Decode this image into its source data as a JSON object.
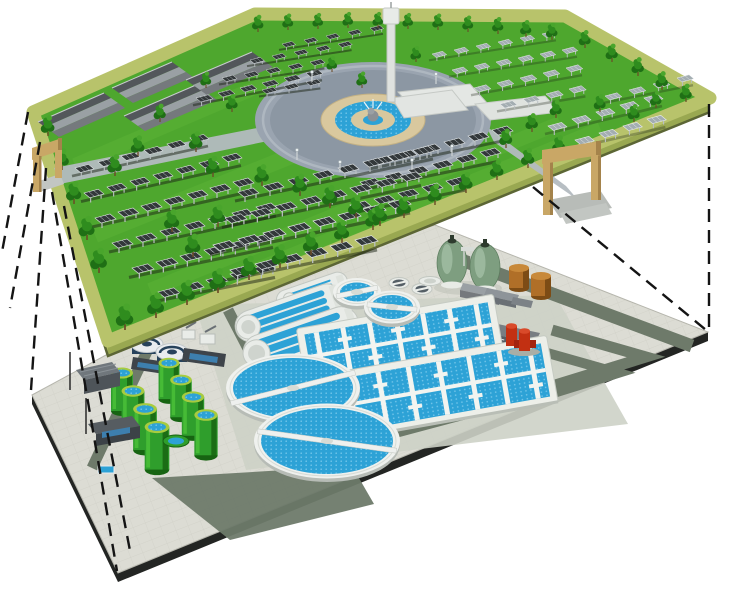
{
  "scene": {
    "type": "exploded-axonometric-illustration",
    "upper_level": {
      "name": "ground-level-solar-park",
      "features": [
        "solar-panel-arrays",
        "landscaped-trees",
        "central-fountain-plaza",
        "service-buildings",
        "observation-tower",
        "entrance-gates",
        "perimeter-edge-band",
        "access-roads"
      ]
    },
    "lower_level": {
      "name": "underground-wastewater-treatment-plant",
      "features": [
        "inlet-pump-station",
        "sludge-thickeners",
        "green-storage-tanks",
        "oxidation-ditches",
        "secondary-clarifiers",
        "aeration-basins",
        "egg-shaped-digesters",
        "gas-holders",
        "blower-buildings",
        "brown-chemical-tanks",
        "red-pipe-gallery",
        "service-roads"
      ]
    },
    "connectors": {
      "type": "dashed-projection-lines",
      "count": 7
    }
  },
  "colors": {
    "background": "#ffffff",
    "park_grass": "#4ea72e",
    "park_grass_light": "#63b93c",
    "park_edge_band": "#b8c36b",
    "park_side_left": "#aeb95f",
    "park_side_right": "#99a851",
    "park_side_shadow": "#5c6635",
    "tree_dark": "#1f6f15",
    "tree_mid": "#2f8c1e",
    "tree_light": "#49a52c",
    "trunk": "#6b4a26",
    "panel_dark": "#33383a",
    "panel_dark_frame": "#e2e6e8",
    "panel_grid": "#c8d0d4",
    "panel_light": "#a3adb1",
    "panel_light_frame": "#eef1f2",
    "panel_leg": "#b9bfc2",
    "row_shadow": "#1c2416",
    "plaza_outer": "#9aa4b0",
    "plaza_inner": "#8c97a3",
    "plaza_ring": "#aeb7c0",
    "fountain_tan": "#d9c89e",
    "fountain_tan_dark": "#c3b184",
    "water_blue": "#2da2d6",
    "water_dot": "#74c6ea",
    "road_upper": "#b3bac0",
    "gate_tan": "#c9a766",
    "gate_tan_dark": "#a4834b",
    "bldg_roof_dark": "#53575b",
    "bldg_roof_light": "#9aa0a4",
    "bldg_wall": "#75797d",
    "tower_white": "#e4e7e4",
    "plant_paving": "#dcdcd4",
    "plant_tile_line": "#c9c9c0",
    "plant_road": "#6e7a6a",
    "plant_apron": "#cdd1c7",
    "slab_edge": "#232523",
    "tank_green": "#2f9e2c",
    "tank_green_light": "#4cc23a",
    "tank_green_dark": "#176412",
    "tank_rim": "#a7cb3f",
    "clarifier_rim": "#eff1ee",
    "clarifier_rim_shadow": "#b7bcb6",
    "machinery_white": "#e9ece8",
    "digester_green": "#7e9e80",
    "digester_green_light": "#a5c0a7",
    "digester_green_dark": "#5c7c5e",
    "digester_cap": "#2e3b2e",
    "brown_tank": "#b06f28",
    "brown_tank_top": "#c8893a",
    "brown_tank_dark": "#7d4c15",
    "red_structure": "#c23012",
    "red_structure_top": "#d94a2a",
    "red_structure_dark": "#a32410",
    "navy_tank": "#27425c",
    "dark_building": "#3e444a",
    "glass_blue": "#3d7fae",
    "projection_line": "#141414"
  },
  "layout": {
    "panel_rows": [
      [
        75,
        168,
        23,
        -6,
        6,
        0.9,
        "d"
      ],
      [
        84,
        193,
        23,
        -6,
        7,
        0.95,
        "d"
      ],
      [
        95,
        218,
        23,
        -6,
        7,
        1,
        "d"
      ],
      [
        112,
        243,
        24,
        -6,
        7,
        1,
        "d"
      ],
      [
        132,
        268,
        24,
        -6,
        6,
        1.05,
        "d"
      ],
      [
        158,
        292,
        24,
        -6,
        5,
        1.05,
        "d"
      ],
      [
        196,
        98,
        22,
        -5,
        6,
        0.8,
        "d"
      ],
      [
        222,
        78,
        22,
        -4,
        5,
        0.72,
        "d"
      ],
      [
        250,
        60,
        22,
        -4,
        5,
        0.68,
        "d"
      ],
      [
        282,
        44,
        22,
        -4,
        5,
        0.65,
        "d"
      ],
      [
        262,
        90,
        22,
        -4,
        3,
        0.72,
        "d"
      ],
      [
        432,
        54,
        22,
        -4,
        6,
        0.7,
        "l"
      ],
      [
        452,
        70,
        22,
        -4,
        6,
        0.75,
        "l"
      ],
      [
        474,
        88,
        23,
        -5,
        5,
        0.8,
        "l"
      ],
      [
        500,
        104,
        23,
        -5,
        4,
        0.82,
        "l"
      ],
      [
        548,
        126,
        24,
        -7,
        5,
        0.9,
        "l"
      ],
      [
        575,
        140,
        24,
        -7,
        4,
        0.92,
        "l"
      ],
      [
        605,
        96,
        24,
        -6,
        4,
        0.8,
        "l"
      ],
      [
        372,
        160,
        24,
        -6,
        6,
        1,
        "d"
      ],
      [
        360,
        182,
        24,
        -6,
        6,
        1,
        "d"
      ],
      [
        350,
        205,
        24,
        -6,
        5,
        1,
        "d"
      ],
      [
        238,
        192,
        25,
        -6,
        8,
        1,
        "d"
      ],
      [
        225,
        218,
        25,
        -6,
        8,
        1.05,
        "d"
      ],
      [
        213,
        245,
        25,
        -6,
        8,
        1.1,
        "d"
      ],
      [
        230,
        270,
        25,
        -6,
        6,
        1.1,
        "d"
      ]
    ],
    "trees": [
      [
        125,
        330,
        1.15
      ],
      [
        156,
        318,
        1.12
      ],
      [
        187,
        305,
        1.1
      ],
      [
        218,
        293,
        1.08
      ],
      [
        249,
        280,
        1.06
      ],
      [
        280,
        268,
        1.04
      ],
      [
        311,
        255,
        1.02
      ],
      [
        342,
        243,
        1.0
      ],
      [
        373,
        230,
        0.98
      ],
      [
        404,
        218,
        0.96
      ],
      [
        435,
        205,
        0.94
      ],
      [
        466,
        193,
        0.92
      ],
      [
        497,
        180,
        0.9
      ],
      [
        528,
        168,
        0.88
      ],
      [
        559,
        155,
        0.86
      ],
      [
        258,
        32,
        0.75
      ],
      [
        288,
        30,
        0.72
      ],
      [
        318,
        29,
        0.7
      ],
      [
        348,
        28,
        0.7
      ],
      [
        378,
        28,
        0.7
      ],
      [
        408,
        29,
        0.7
      ],
      [
        438,
        30,
        0.72
      ],
      [
        468,
        32,
        0.72
      ],
      [
        498,
        34,
        0.74
      ],
      [
        526,
        37,
        0.74
      ],
      [
        552,
        40,
        0.76
      ],
      [
        585,
        48,
        0.78
      ],
      [
        612,
        62,
        0.8
      ],
      [
        638,
        76,
        0.82
      ],
      [
        662,
        90,
        0.82
      ],
      [
        686,
        102,
        0.8
      ],
      [
        48,
        136,
        0.9
      ],
      [
        62,
        170,
        0.95
      ],
      [
        74,
        204,
        1.0
      ],
      [
        87,
        240,
        1.05
      ],
      [
        99,
        273,
        1.1
      ],
      [
        115,
        176,
        0.95
      ],
      [
        138,
        156,
        0.9
      ],
      [
        196,
        152,
        0.9
      ],
      [
        213,
        177,
        0.92
      ],
      [
        172,
        232,
        1.0
      ],
      [
        193,
        257,
        1.02
      ],
      [
        218,
        227,
        0.98
      ],
      [
        262,
        186,
        0.95
      ],
      [
        300,
        196,
        0.97
      ],
      [
        330,
        208,
        1.0
      ],
      [
        356,
        218,
        1.0
      ],
      [
        380,
        226,
        1.0
      ],
      [
        160,
        122,
        0.8
      ],
      [
        206,
        88,
        0.72
      ],
      [
        232,
        112,
        0.78
      ],
      [
        332,
        72,
        0.7
      ],
      [
        362,
        88,
        0.72
      ],
      [
        416,
        62,
        0.7
      ],
      [
        506,
        148,
        0.85
      ],
      [
        532,
        132,
        0.82
      ],
      [
        556,
        118,
        0.8
      ],
      [
        600,
        112,
        0.78
      ],
      [
        634,
        122,
        0.78
      ],
      [
        656,
        108,
        0.76
      ]
    ],
    "green_tanks": [
      [
        122,
        373,
        1.0
      ],
      [
        133,
        391,
        1.04
      ],
      [
        145,
        409,
        1.08
      ],
      [
        157,
        427,
        1.12
      ],
      [
        169,
        363,
        0.95
      ],
      [
        181,
        380,
        0.98
      ],
      [
        193,
        397,
        1.02
      ],
      [
        206,
        415,
        1.06
      ]
    ],
    "clarifiers": [
      {
        "cx": 357,
        "cy": 292,
        "rx": 17,
        "ry": 9.5,
        "rot": -12
      },
      {
        "cx": 392,
        "cy": 307,
        "rx": 21,
        "ry": 12,
        "rot": 6
      },
      {
        "cx": 293,
        "cy": 388,
        "rx": 60,
        "ry": 30,
        "rot": -14
      },
      {
        "cx": 327,
        "cy": 441,
        "rx": 66,
        "ry": 33,
        "rot": 8
      }
    ],
    "basins": [
      {
        "cx": 400,
        "cy": 341,
        "L": 186,
        "W": 46,
        "rot": -10,
        "strips": 7
      },
      {
        "cx": 443,
        "cy": 388,
        "L": 208,
        "W": 54,
        "rot": -10,
        "strips": 7
      }
    ],
    "ditches": [
      {
        "cx": 312,
        "cy": 291,
        "rot": -19,
        "L": 74,
        "W": 20
      },
      {
        "cx": 289,
        "cy": 313,
        "rot": -19,
        "L": 112,
        "W": 32
      },
      {
        "cx": 301,
        "cy": 338,
        "rot": -19,
        "L": 120,
        "W": 35
      }
    ],
    "dashes": [
      [
        28,
        112,
        2,
        252
      ],
      [
        40,
        142,
        10,
        308
      ],
      [
        46,
        168,
        31,
        390
      ],
      [
        52,
        192,
        117,
        571
      ],
      [
        64,
        206,
        131,
        556
      ],
      [
        709,
        104,
        709,
        329
      ],
      [
        533,
        187,
        706,
        330
      ]
    ],
    "buildings_upper": [
      [
        38,
        122,
        104,
        93
      ],
      [
        124,
        116,
        196,
        85
      ],
      [
        112,
        88,
        172,
        62
      ],
      [
        186,
        80,
        252,
        52
      ]
    ],
    "lamps": [
      [
        297,
        160
      ],
      [
        340,
        172
      ],
      [
        412,
        170
      ],
      [
        452,
        156
      ],
      [
        312,
        82
      ],
      [
        436,
        84
      ]
    ]
  }
}
